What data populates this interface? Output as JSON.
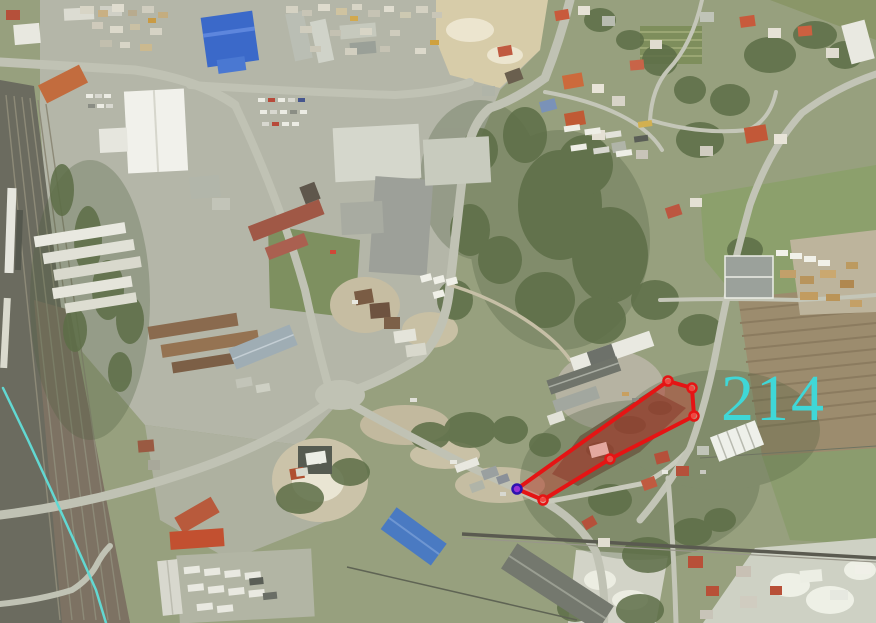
{
  "map_overlay": {
    "parcel_label": {
      "text": "214",
      "color": "#3fd7d7",
      "x": 721,
      "y": 420,
      "font_size": 66,
      "letter_spacing": 2
    },
    "parcel_polygon": {
      "points": "517,489 668,381 692,388 694,416 610,459 543,500",
      "stroke_color": "#e51414",
      "stroke_width": 4,
      "fill_color": "rgba(226,42,36,0.33)"
    },
    "vertex_markers": {
      "points": [
        [
          668,
          381
        ],
        [
          692,
          388
        ],
        [
          694,
          416
        ],
        [
          610,
          459
        ],
        [
          543,
          500
        ]
      ],
      "radius": 4.5,
      "stroke_color": "#e51414",
      "stroke_width": 2.5,
      "fill_color": "rgba(255,120,110,0.5)"
    },
    "selected_vertex_marker": {
      "cx": 517,
      "cy": 489,
      "radius": 4.5,
      "fill_color": "#9633d6",
      "stroke_color": "#2d12b0",
      "stroke_width": 2.5
    },
    "boundary_polyline": {
      "points": "3,388 28,440 52,492 76,545 96,590 106,623",
      "color": "#62d8d2",
      "width": 2.5
    }
  }
}
